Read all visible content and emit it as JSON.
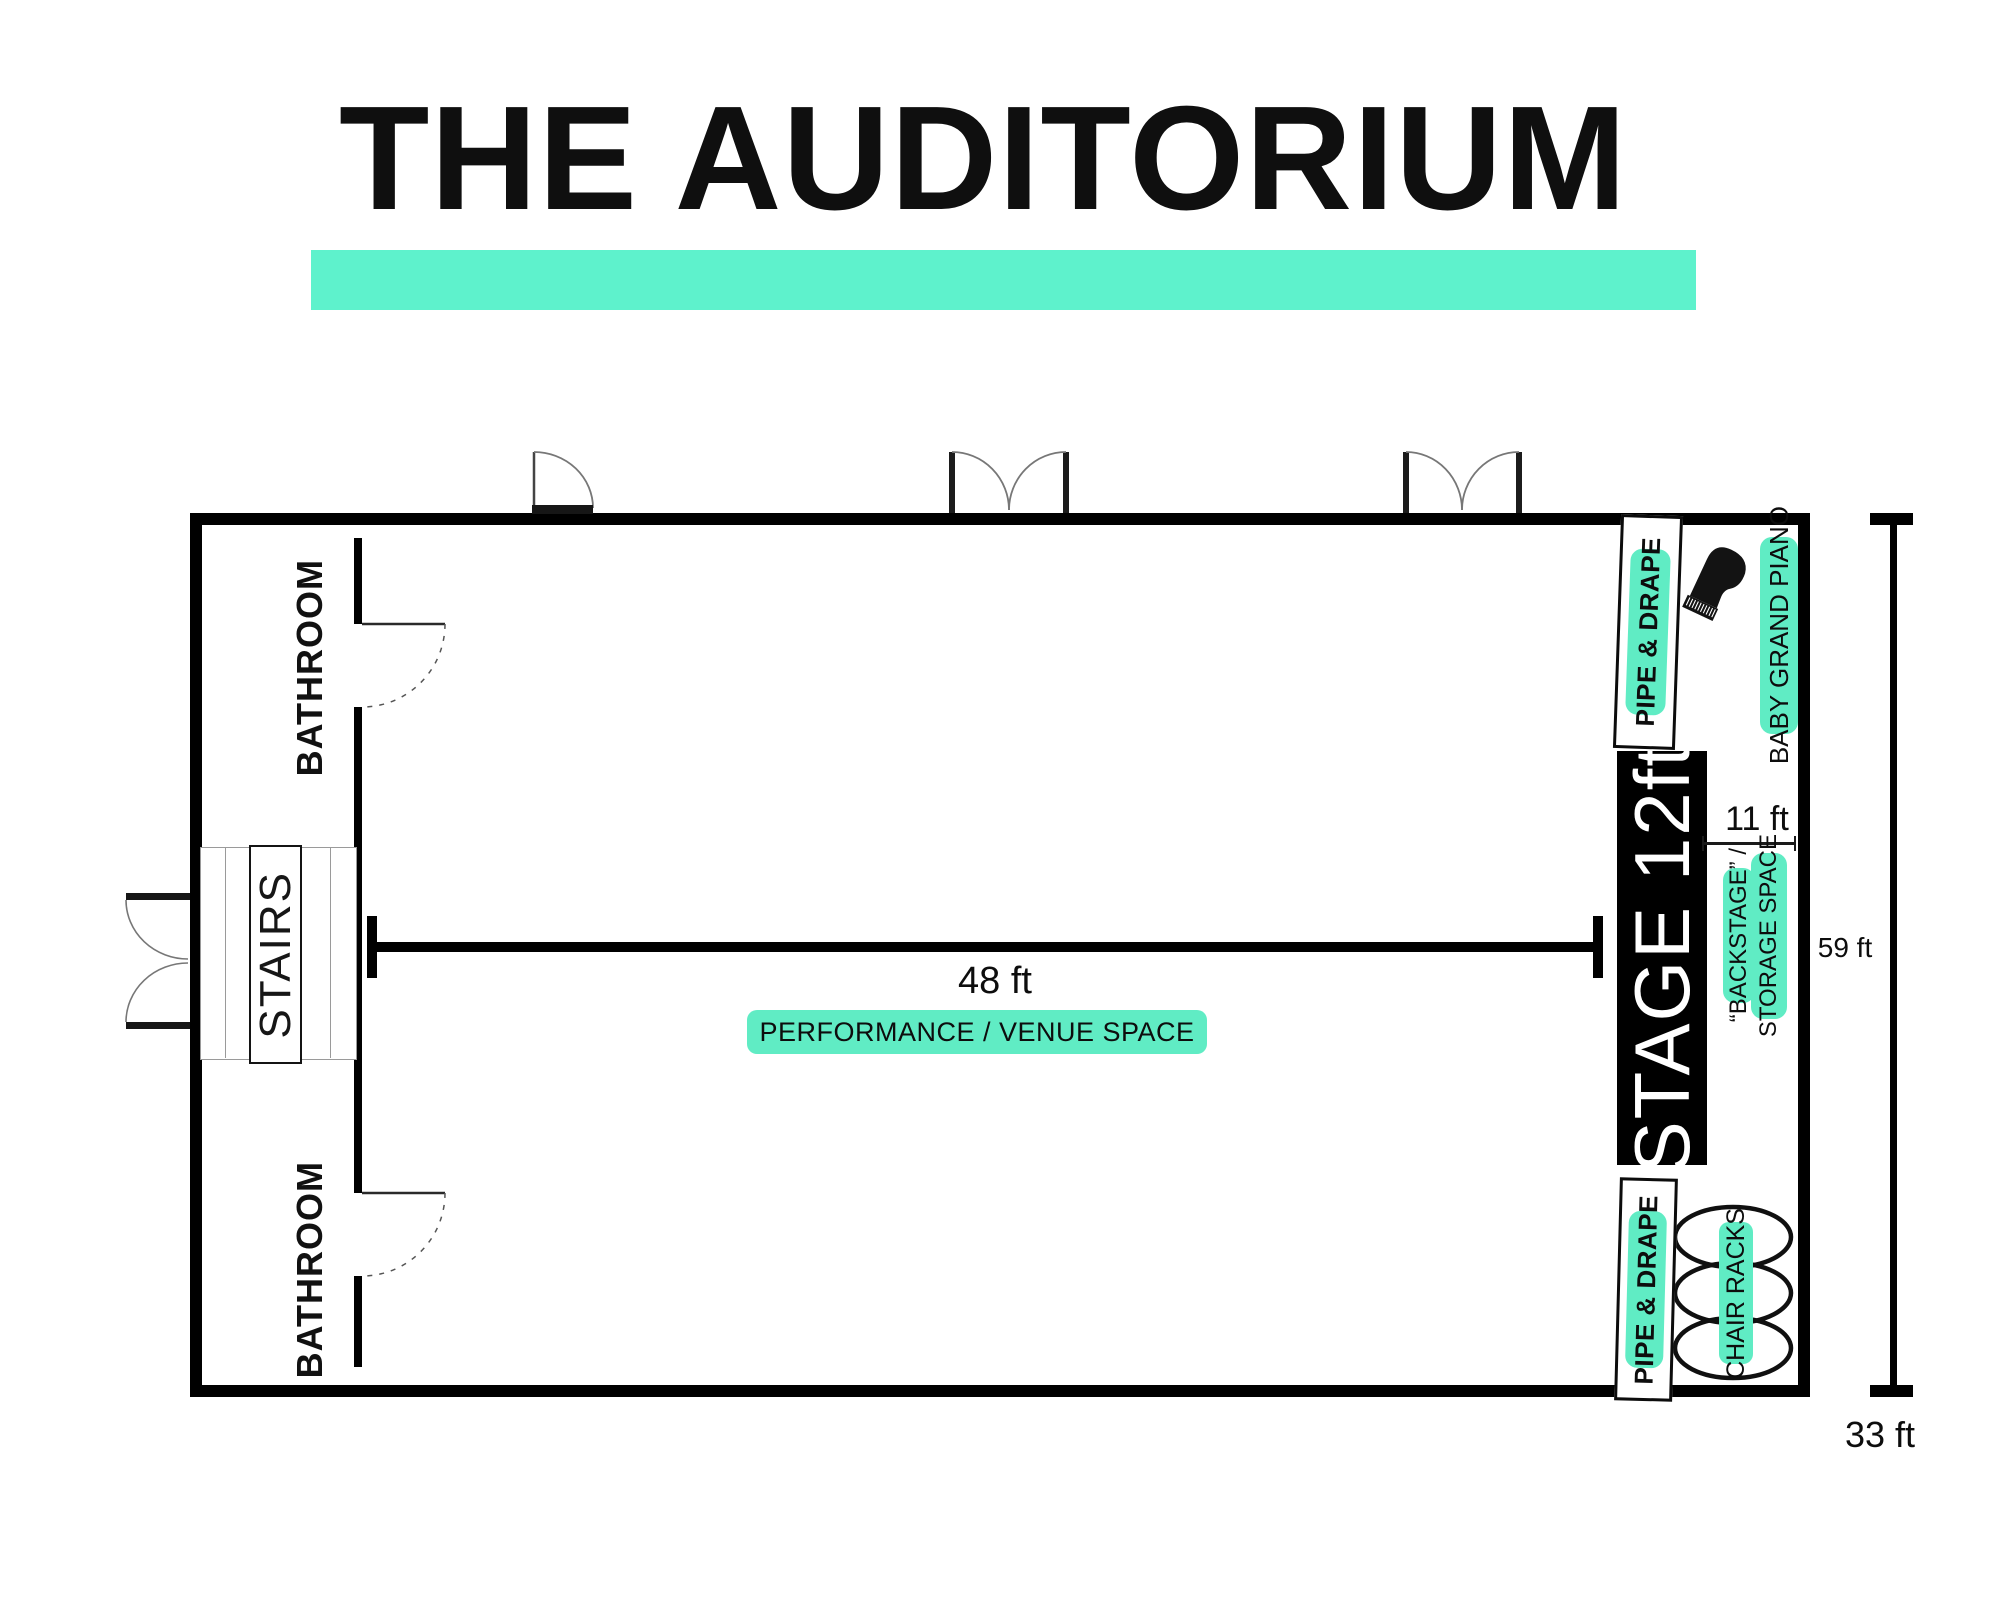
{
  "title": {
    "text": "THE AUDITORIUM"
  },
  "colors": {
    "accent_bar": "#5ef2cc",
    "badge": "#60ecc4",
    "ink": "#000000",
    "stage_bg": "#000000",
    "stage_text": "#ffffff"
  },
  "rooms": {
    "bathroom_top": {
      "label": "BATHROOM"
    },
    "bathroom_bottom": {
      "label": "BATHROOM"
    },
    "stairs": {
      "label": "STAIRS"
    },
    "stage": {
      "label": "STAGE 12ft"
    }
  },
  "areas": {
    "performance": {
      "label": "PERFORMANCE / VENUE SPACE"
    },
    "backstage": {
      "line1": "“BACKSTAGE” /",
      "line2": "STORAGE SPACE"
    }
  },
  "fixtures": {
    "pipe_drape_top": {
      "label": "PIPE & DRAPE"
    },
    "pipe_drape_bottom": {
      "label": "PIPE & DRAPE"
    },
    "piano": {
      "label": "BABY GRAND PIANO"
    },
    "chair_racks": {
      "label": "CHAIR RACKS"
    }
  },
  "dimensions": {
    "performance_width": {
      "label": "48 ft"
    },
    "backstage_depth": {
      "label": "11 ft"
    },
    "room_length": {
      "label": "59 ft"
    },
    "room_width": {
      "label": "33 ft"
    }
  }
}
